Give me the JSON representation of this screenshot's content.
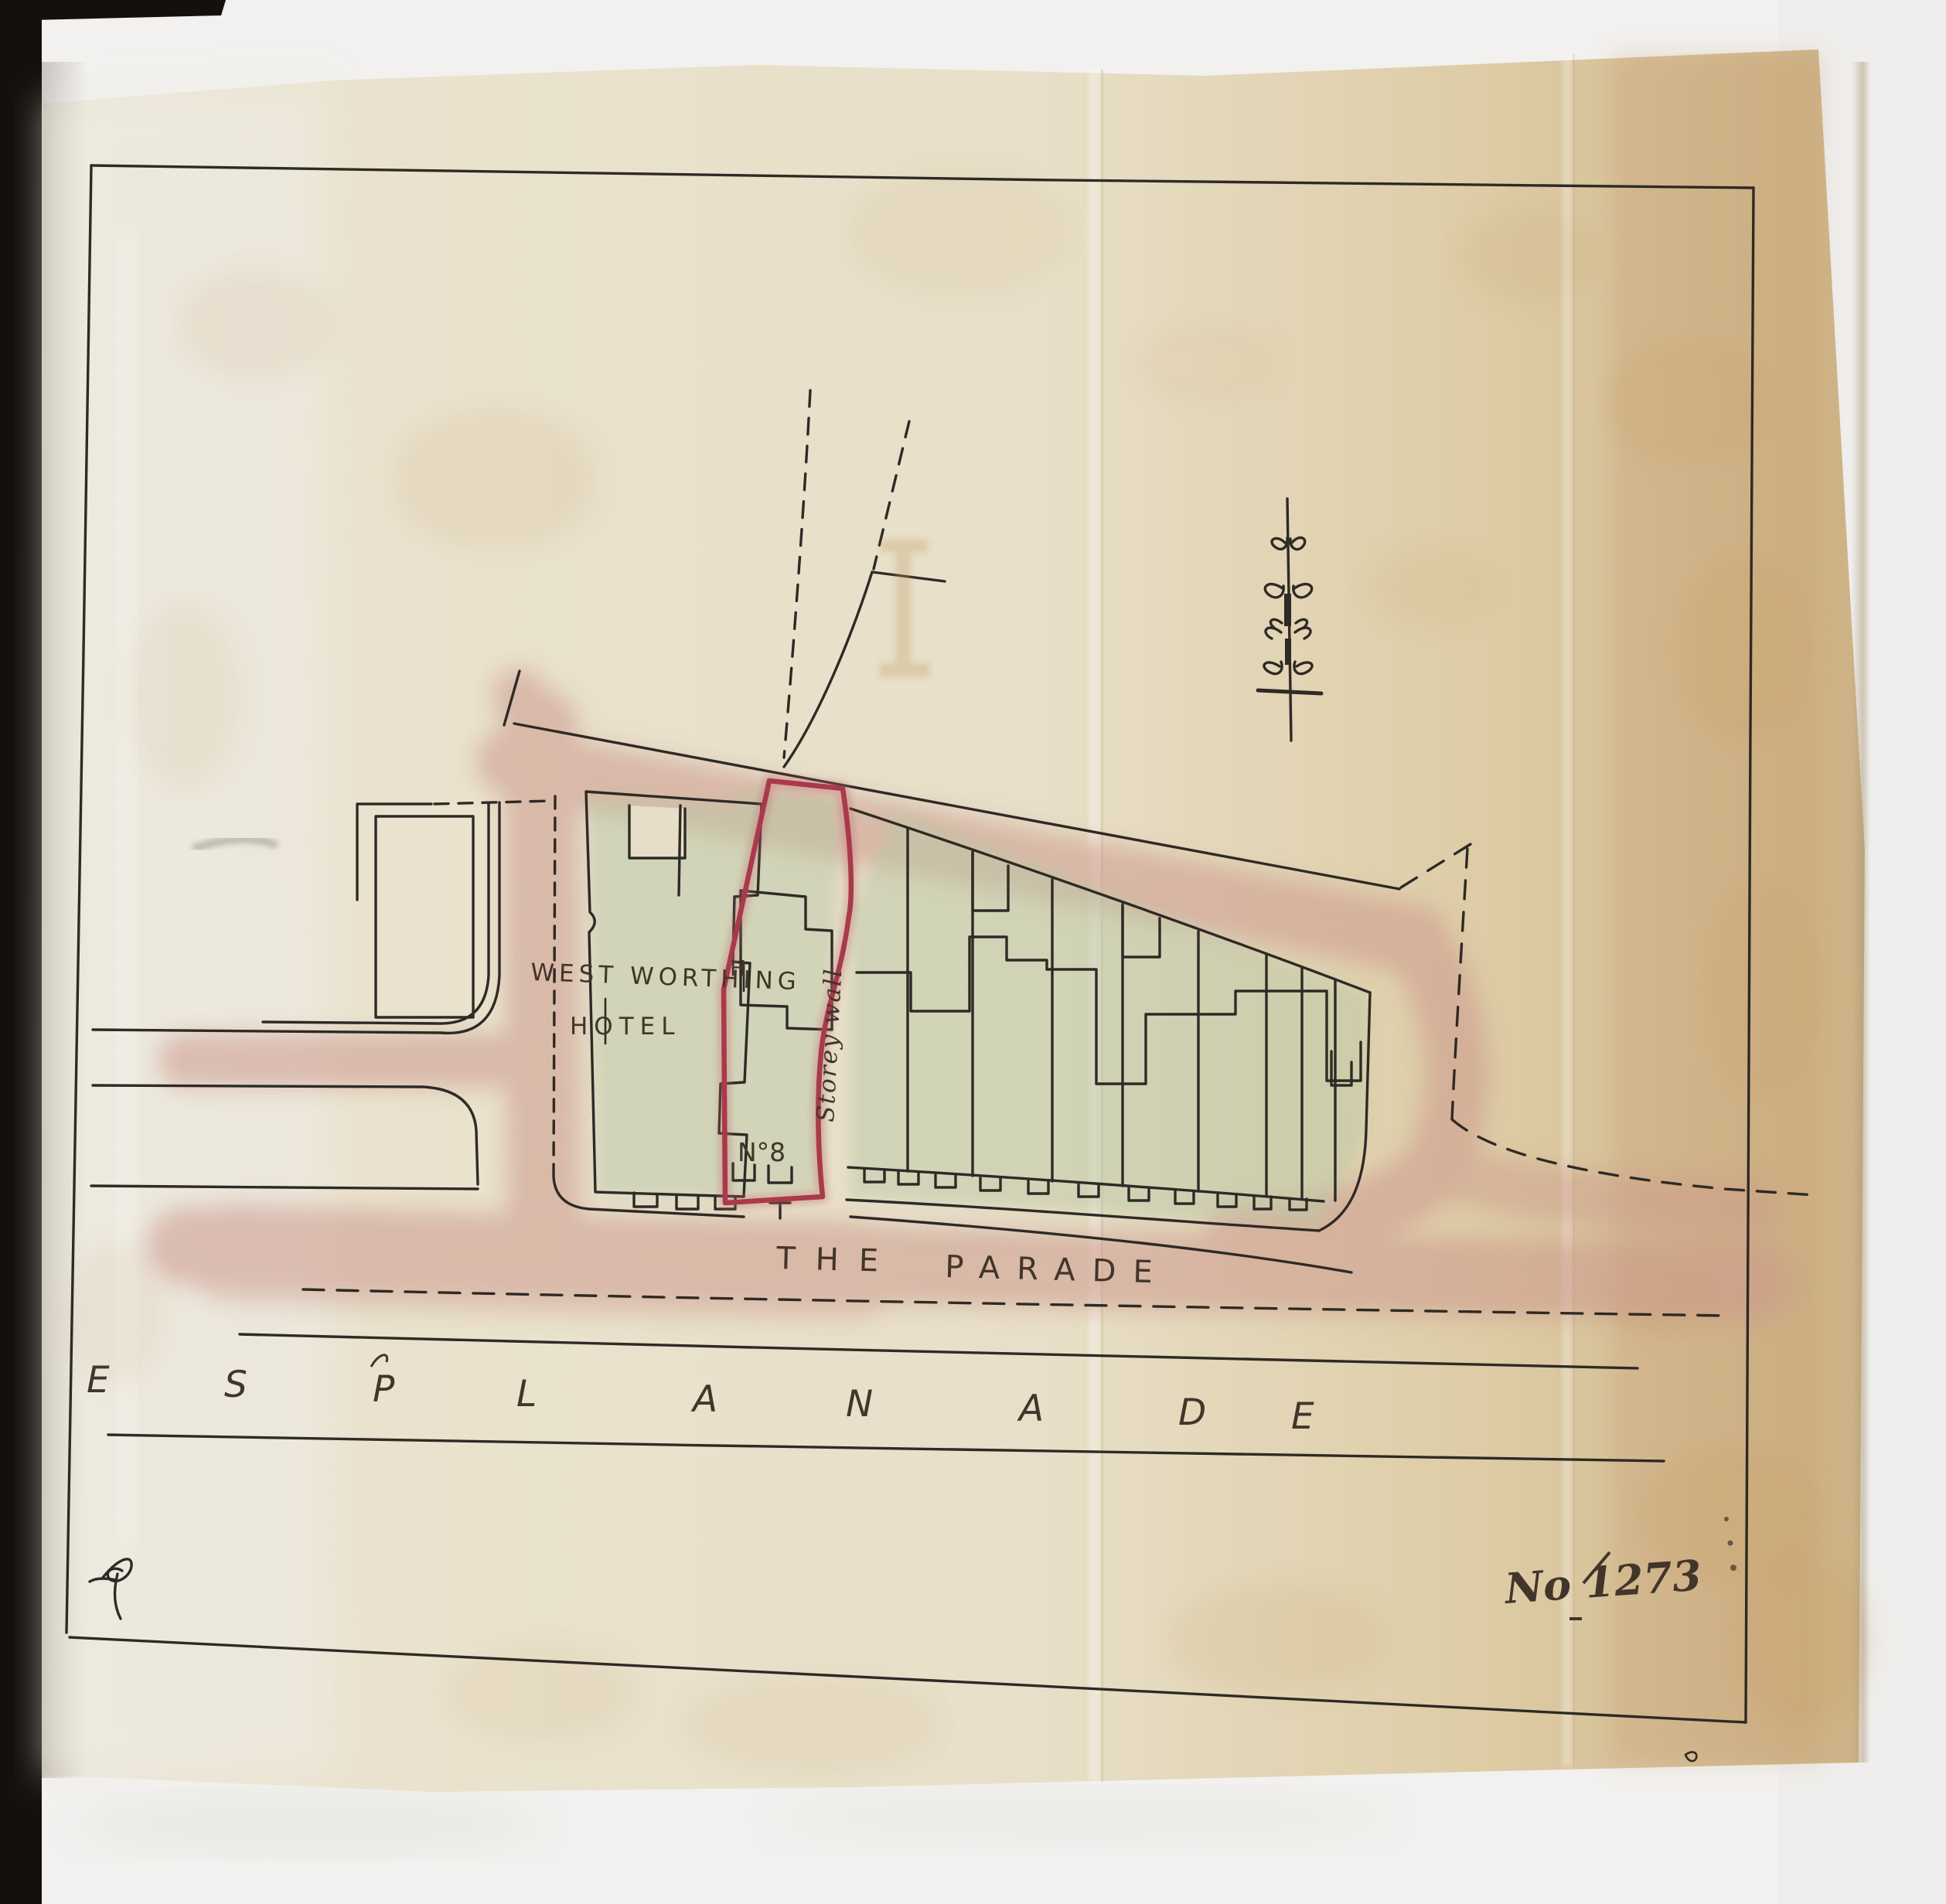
{
  "page": {
    "title": "Plan of property adjoining West Worthing Hotel, The Parade / Esplanade",
    "plan_number": "No 1273",
    "labels": {
      "hotel": {
        "line1": "WEST WORTHING",
        "line2": "HOTEL"
      },
      "survey_mark": "H",
      "benchmark_cross": "+",
      "plot_number": "N°8",
      "boundary_wall": "Storey wall",
      "parade": {
        "word1": "THE",
        "word2": "PARADE"
      },
      "esplanade": {
        "word": "ESPLANADE",
        "letters": [
          "E",
          "S",
          "P",
          "L",
          "A",
          "N",
          "A",
          "D",
          "E"
        ]
      }
    },
    "marks": {
      "north_arrow": "ornamental-compass-needle",
      "paraph": "ink-flourish",
      "ink_offset_stain": "I-beam ghost of compass ornament"
    },
    "colors": {
      "paper": "#e8dfc8",
      "paper_edge": "#d2b88e",
      "road_wash": "#cc998d",
      "building_wash": "#bac7a6",
      "boundary_red": "#a83a4b",
      "ink": "#2e2a25",
      "handwriting": "#42352a",
      "spine_black": "#14100d"
    }
  }
}
